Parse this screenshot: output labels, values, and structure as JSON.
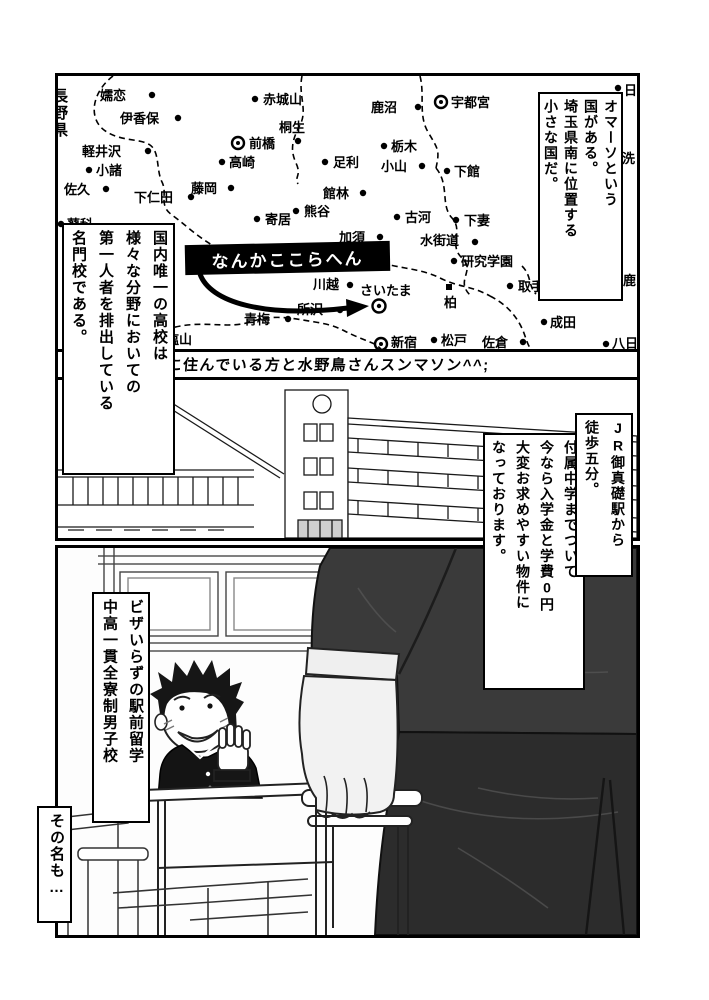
{
  "page": {
    "bg": "#ffffff",
    "ink": "#000000"
  },
  "panel1": {
    "caption_country": "オマーソという\n国がある。\n埼玉県南に位置する\n小さな国だ。",
    "caption_school": "国内唯一の高校は\n様々な分野においての\n第一人者を排出している\n名門校である。",
    "prefecture_label": "長野県",
    "map_note": "なんかここらへん",
    "cities": [
      "嬬恋",
      "伊香保",
      "軽井沢",
      "小諸",
      "佐久",
      "蓼科",
      "下仁田",
      "藤岡",
      "前橋",
      "高崎",
      "赤城山",
      "桐生",
      "鹿沼",
      "宇都宮",
      "栃木",
      "足利",
      "小山",
      "下館",
      "館林",
      "熊谷",
      "寄居",
      "加須",
      "古河",
      "下妻",
      "水街道",
      "研究学園",
      "取手",
      "柏",
      "川越",
      "さいたま",
      "所沢",
      "青梅",
      "塩山",
      "松戸",
      "新宿",
      "佐倉",
      "成田",
      "八日",
      "日",
      "洗",
      "鹿"
    ]
  },
  "gutter_note": "そこらへんに住んでいる方と水野鳥さんスンマソン^^;",
  "panel2": {
    "caption_access": "JR御真礎駅から\n徒歩五分。",
    "caption_sales": "付属中学までついて\n今なら入学金と学費0円\n大変お求めやすい物件に\nなっております。"
  },
  "panel3": {
    "caption_school_type": "ビザいらずの駅前留学\n中高一貫全寮制男子校",
    "caption_name": "その名も…"
  }
}
